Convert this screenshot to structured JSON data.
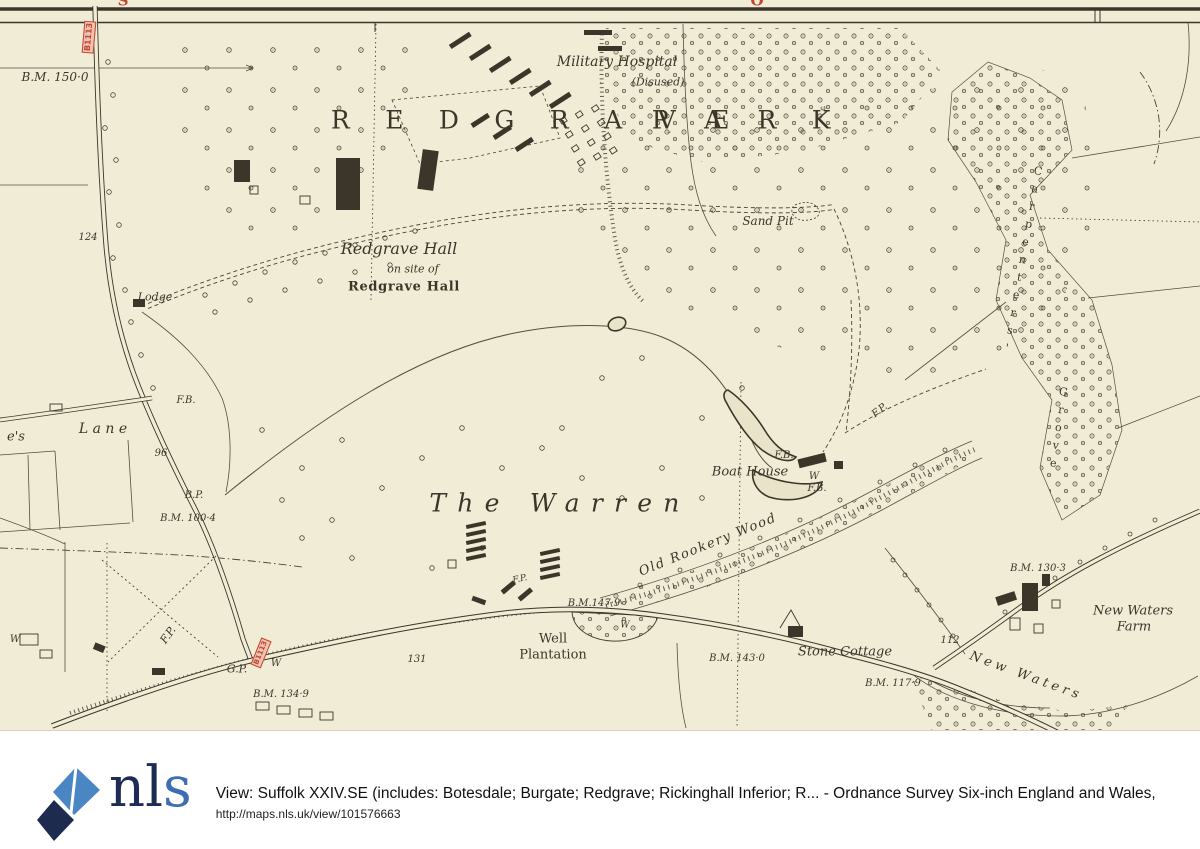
{
  "colors": {
    "map-bg": "#f1ecd6",
    "map-ink": "#3c362a",
    "map-line": "#55503f",
    "road-red": "#c2452e",
    "road-red-fill": "#eec3b2",
    "water-fill": "#e9e3ca",
    "logo-blue": "#3e6db2",
    "logo-navy": "#1e2c55",
    "footer-bg": "#ffffff",
    "footer-text": "#111111"
  },
  "footer": {
    "logo_nl": "nl",
    "logo_s": "s",
    "title": "View: Suffolk XXIV.SE (includes: Botesdale; Burgate; Redgrave; Rickinghall Inferior; R... - Ordnance Survey Six-inch England and Wales,",
    "url": "http://maps.nls.uk/view/101576663"
  },
  "map": {
    "labels": [
      {
        "t": "B.M. 150·0",
        "x": 55,
        "y": 77,
        "fs": 12,
        "c": "italic"
      },
      {
        "t": "B1113",
        "x": 89,
        "y": 37,
        "fs": 8,
        "c": "red-box",
        "r": -85
      },
      {
        "t": "S",
        "x": 123,
        "y": 1,
        "fs": 15,
        "c": "red"
      },
      {
        "t": "O",
        "x": 757,
        "y": 1,
        "fs": 15,
        "c": "red"
      },
      {
        "t": "Military Hospital",
        "x": 617,
        "y": 62,
        "fs": 14,
        "c": "italic"
      },
      {
        "t": "(Disused)",
        "x": 658,
        "y": 82,
        "fs": 11,
        "c": "italic"
      },
      {
        "t": "R E D G R A V E",
        "x": 537,
        "y": 120,
        "fs": 25,
        "c": "roman",
        "ls": 0.55
      },
      {
        "t": "P A R K",
        "x": 748,
        "y": 120,
        "fs": 25,
        "c": "roman",
        "ls": 0.55
      },
      {
        "t": "Sand Pit",
        "x": 768,
        "y": 221,
        "fs": 12,
        "c": "italic"
      },
      {
        "t": "Redgrave Hall",
        "x": 399,
        "y": 249,
        "fs": 16,
        "c": "italic"
      },
      {
        "t": "on site of",
        "x": 413,
        "y": 269,
        "fs": 11,
        "c": "italic"
      },
      {
        "t": "Redgrave Hall",
        "x": 404,
        "y": 287,
        "fs": 13,
        "c": "gothic"
      },
      {
        "t": "Lodge",
        "x": 155,
        "y": 297,
        "fs": 11,
        "c": "italic"
      },
      {
        "t": "124",
        "x": 88,
        "y": 238,
        "fs": 10,
        "c": "italic"
      },
      {
        "t": "e's",
        "x": 16,
        "y": 437,
        "fs": 13,
        "c": "italic"
      },
      {
        "t": "L a n e",
        "x": 103,
        "y": 429,
        "fs": 14,
        "c": "italic"
      },
      {
        "t": "96",
        "x": 161,
        "y": 454,
        "fs": 10,
        "c": "italic"
      },
      {
        "t": "F.B.",
        "x": 186,
        "y": 401,
        "fs": 10,
        "c": "italic"
      },
      {
        "t": "B.P.",
        "x": 194,
        "y": 496,
        "fs": 10,
        "c": "italic"
      },
      {
        "t": "B.M. 100·4",
        "x": 188,
        "y": 519,
        "fs": 10,
        "c": "italic"
      },
      {
        "t": "The Warren",
        "x": 560,
        "y": 503,
        "fs": 25,
        "c": "italic",
        "ls": 0.45
      },
      {
        "t": "Boat House",
        "x": 750,
        "y": 472,
        "fs": 13,
        "c": "italic"
      },
      {
        "t": "W",
        "x": 814,
        "y": 477,
        "fs": 10,
        "c": "italic"
      },
      {
        "t": "F.B.",
        "x": 784,
        "y": 456,
        "fs": 10,
        "c": "italic"
      },
      {
        "t": "F.B.",
        "x": 817,
        "y": 489,
        "fs": 10,
        "c": "italic"
      },
      {
        "t": "F.P.",
        "x": 880,
        "y": 411,
        "fs": 10,
        "c": "italic",
        "r": -38
      },
      {
        "t": "Old Rookery Wood",
        "x": 708,
        "y": 545,
        "fs": 13,
        "c": "italic",
        "r": -22,
        "ls": 0.12
      },
      {
        "t": "B.M.147·9",
        "x": 594,
        "y": 604,
        "fs": 10,
        "c": "italic"
      },
      {
        "t": "Well",
        "x": 553,
        "y": 639,
        "fs": 13,
        "c": "roman"
      },
      {
        "t": "Plantation",
        "x": 553,
        "y": 655,
        "fs": 13,
        "c": "roman"
      },
      {
        "t": "131",
        "x": 417,
        "y": 660,
        "fs": 10,
        "c": "italic"
      },
      {
        "t": "B.M. 143·0",
        "x": 737,
        "y": 659,
        "fs": 10,
        "c": "italic"
      },
      {
        "t": "Stone Cottage",
        "x": 845,
        "y": 652,
        "fs": 13,
        "c": "italic"
      },
      {
        "t": "B.M. 117·9",
        "x": 893,
        "y": 684,
        "fs": 10,
        "c": "italic"
      },
      {
        "t": "B.M. 130·3",
        "x": 1038,
        "y": 569,
        "fs": 10,
        "c": "italic"
      },
      {
        "t": "New Waters",
        "x": 1133,
        "y": 611,
        "fs": 13,
        "c": "italic"
      },
      {
        "t": "Farm",
        "x": 1134,
        "y": 627,
        "fs": 13,
        "c": "italic"
      },
      {
        "t": "112",
        "x": 950,
        "y": 641,
        "fs": 10,
        "c": "italic"
      },
      {
        "t": "New Waters",
        "x": 1026,
        "y": 676,
        "fs": 13,
        "c": "italic",
        "r": 20,
        "ls": 0.3
      },
      {
        "t": "F.P.",
        "x": 168,
        "y": 635,
        "fs": 11,
        "c": "italic",
        "r": -55
      },
      {
        "t": "G.P.",
        "x": 237,
        "y": 669,
        "fs": 11,
        "c": "italic"
      },
      {
        "t": "B1113",
        "x": 261,
        "y": 653,
        "fs": 7,
        "c": "red-box",
        "r": -68
      },
      {
        "t": "W",
        "x": 276,
        "y": 664,
        "fs": 10,
        "c": "italic"
      },
      {
        "t": "B.M. 134·9",
        "x": 281,
        "y": 695,
        "fs": 10,
        "c": "italic"
      },
      {
        "t": "W",
        "x": 15,
        "y": 640,
        "fs": 10,
        "c": "italic"
      },
      {
        "t": "W",
        "x": 625,
        "y": 626,
        "fs": 9,
        "c": "italic"
      },
      {
        "t": "Carpenters'",
        "x": 1022,
        "y": 262,
        "fs": 11,
        "c": "stack",
        "r": 10
      },
      {
        "t": "Grove",
        "x": 1058,
        "y": 430,
        "fs": 11,
        "c": "stack",
        "r": 8
      },
      {
        "t": "F.P.",
        "x": 520,
        "y": 580,
        "fs": 9,
        "c": "italic",
        "r": -12
      }
    ]
  }
}
